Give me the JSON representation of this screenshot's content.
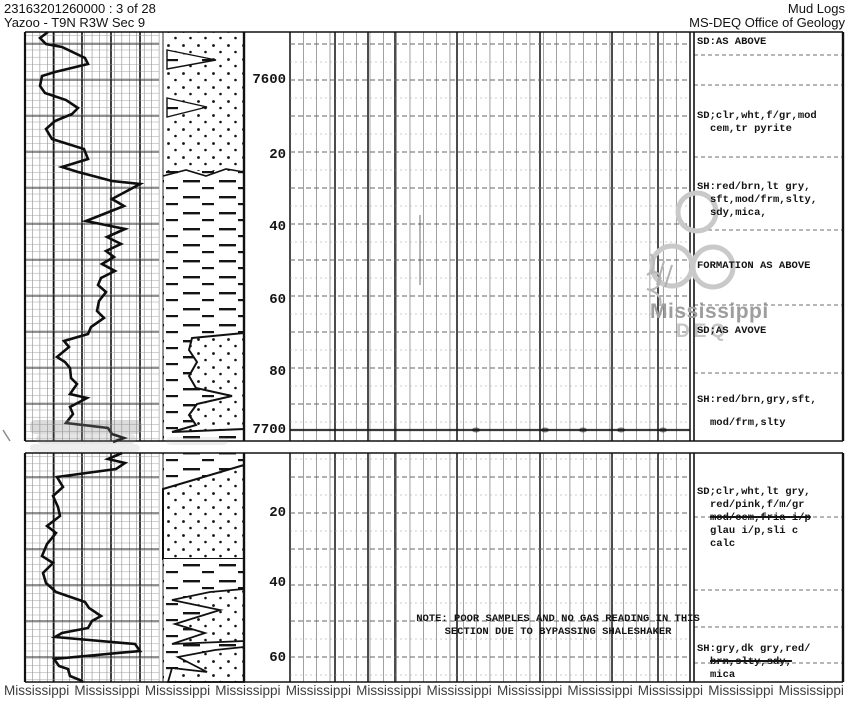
{
  "header": {
    "doc_ref": "23163201260000 : 3 of 28",
    "well_name": "Yazoo - T9N R3W Sec 9",
    "doc_type": "Mud Logs",
    "agency": "MS-DEQ Office of Geology"
  },
  "note": {
    "line1": "NOTE: POOR SAMPLES AND NO GAS READING IN THIS",
    "line2": "SECTION DUE TO BYPASSING SHALESHAKER"
  },
  "watermark": {
    "word": "Mississippi",
    "deq": "DEQ",
    "bottom_repeat": 12
  },
  "colors": {
    "ink": "#141414",
    "grid_light": "#999999",
    "grid_mid": "#555555",
    "grid_heavy": "#111111",
    "watermark_gray": "#c9c9c9",
    "watermark_text": "#9e9e9e",
    "footer_gray": "#3d3d3d"
  },
  "chart_data": {
    "type": "well-log",
    "depth_unit": "ft",
    "legend": {
      "dots": "sandstone",
      "dashes": "shale"
    },
    "panels": [
      {
        "top": 32,
        "bot": 441,
        "anchor": 80
      },
      {
        "top": 453,
        "bot": 682,
        "anchor": 513
      }
    ],
    "left_track": {
      "x0": 25,
      "x1": 159,
      "light_dx": 7.45,
      "heavy_x": [
        25,
        53.5,
        82,
        111,
        140
      ]
    },
    "mid_track": {
      "x0": 290,
      "x1": 690,
      "light_dx": 13.33,
      "heavy_x": [
        290,
        335,
        368,
        395,
        457,
        540,
        612,
        658,
        690
      ]
    },
    "right_track": {
      "x0": 694,
      "x1": 843,
      "sep_y": [
        55,
        85,
        157,
        230,
        305,
        373,
        517,
        590,
        627,
        663
      ]
    },
    "panel_border_y": [
      32,
      441,
      453,
      682
    ],
    "vertical_borders": [
      [
        25,
        2.2
      ],
      [
        163,
        0.9
      ],
      [
        244,
        2.4
      ],
      [
        694,
        1.6
      ],
      [
        843,
        2.4
      ]
    ],
    "depth_labels": [
      {
        "text": "7600",
        "y": 80
      },
      {
        "text": "20",
        "y": 155
      },
      {
        "text": "40",
        "y": 227
      },
      {
        "text": "60",
        "y": 300
      },
      {
        "text": "80",
        "y": 372
      },
      {
        "text": "7700",
        "y": 430
      },
      {
        "text": "20",
        "y": 513
      },
      {
        "text": "40",
        "y": 583
      },
      {
        "text": "60",
        "y": 658
      }
    ],
    "descriptions": [
      {
        "y": 36,
        "lines": [
          {
            "t": "SD:AS ABOVE"
          }
        ]
      },
      {
        "y": 110,
        "lines": [
          {
            "t": "SD;clr,wht,f/gr,mod"
          },
          {
            "t": "cem,tr pyrite",
            "indent": 1
          }
        ]
      },
      {
        "y": 181,
        "lines": [
          {
            "t": "SH:red/brn,lt gry,"
          },
          {
            "t": "sft,mod/frm,slty,",
            "indent": 1
          },
          {
            "t": "sdy,mica,",
            "indent": 1
          }
        ]
      },
      {
        "y": 260,
        "lines": [
          {
            "t": "FORMATION AS ABOVE"
          }
        ]
      },
      {
        "y": 325,
        "lines": [
          {
            "t": "SD;AS AVOVE"
          }
        ]
      },
      {
        "y": 394,
        "lines": [
          {
            "t": "SH:red/brn,gry,sft,"
          },
          {
            "t": "mod/frm,slty",
            "indent": 1,
            "gap": 10
          }
        ]
      },
      {
        "y": 486,
        "lines": [
          {
            "t": "SD;clr,wht,lt gry,"
          },
          {
            "t": "red/pink,f/m/gr",
            "indent": 1
          },
          {
            "t": "mod/cem,fria i/p",
            "indent": 1,
            "struck": true
          },
          {
            "t": "glau i/p,sli c",
            "indent": 1
          },
          {
            "t": "calc",
            "indent": 1
          }
        ]
      },
      {
        "y": 643,
        "lines": [
          {
            "t": "SH:gry,dk gry,red/"
          },
          {
            "t": "brn,slty,sdy,",
            "indent": 1,
            "struck": true
          },
          {
            "t": "mica",
            "indent": 1
          }
        ]
      }
    ],
    "curve": {
      "panel1": [
        [
          48,
          32
        ],
        [
          40,
          38
        ],
        [
          46,
          44
        ],
        [
          62,
          47
        ],
        [
          85,
          58
        ],
        [
          88,
          64
        ],
        [
          55,
          72
        ],
        [
          42,
          76
        ],
        [
          40,
          86
        ],
        [
          45,
          93
        ],
        [
          66,
          100
        ],
        [
          78,
          108
        ],
        [
          72,
          114
        ],
        [
          55,
          121
        ],
        [
          46,
          129
        ],
        [
          52,
          139
        ],
        [
          84,
          149
        ],
        [
          88,
          159
        ],
        [
          62,
          167
        ],
        [
          78,
          172
        ],
        [
          97,
          177
        ],
        [
          112,
          181
        ],
        [
          140,
          184
        ],
        [
          112,
          199
        ],
        [
          124,
          206
        ],
        [
          86,
          221
        ],
        [
          125,
          229
        ],
        [
          107,
          237
        ],
        [
          121,
          244
        ],
        [
          106,
          251
        ],
        [
          114,
          257
        ],
        [
          102,
          264
        ],
        [
          115,
          271
        ],
        [
          101,
          278
        ],
        [
          98,
          285
        ],
        [
          106,
          292
        ],
        [
          99,
          301
        ],
        [
          97,
          311
        ],
        [
          104,
          318
        ],
        [
          91,
          327
        ],
        [
          88,
          334
        ],
        [
          64,
          341
        ],
        [
          69,
          347
        ],
        [
          57,
          357
        ],
        [
          65,
          362
        ],
        [
          70,
          368
        ],
        [
          71,
          378
        ],
        [
          77,
          384
        ],
        [
          70,
          394
        ],
        [
          87,
          398
        ],
        [
          70,
          407
        ],
        [
          73,
          414
        ],
        [
          66,
          423
        ],
        [
          108,
          428
        ],
        [
          112,
          434
        ],
        [
          124,
          438
        ],
        [
          113,
          442
        ]
      ],
      "panel2": [
        [
          122,
          453
        ],
        [
          108,
          459
        ],
        [
          125,
          463
        ],
        [
          116,
          469
        ],
        [
          57,
          477
        ],
        [
          63,
          487
        ],
        [
          53,
          496
        ],
        [
          58,
          507
        ],
        [
          60,
          516
        ],
        [
          47,
          526
        ],
        [
          56,
          533
        ],
        [
          47,
          544
        ],
        [
          42,
          556
        ],
        [
          53,
          563
        ],
        [
          43,
          573
        ],
        [
          46,
          583
        ],
        [
          56,
          592
        ],
        [
          85,
          602
        ],
        [
          89,
          608
        ],
        [
          101,
          616
        ],
        [
          92,
          621
        ],
        [
          88,
          628
        ],
        [
          62,
          633
        ],
        [
          55,
          637
        ],
        [
          135,
          644
        ],
        [
          140,
          651
        ],
        [
          54,
          659
        ],
        [
          59,
          666
        ],
        [
          68,
          669
        ],
        [
          70,
          676
        ],
        [
          80,
          680
        ],
        [
          83,
          682
        ]
      ]
    },
    "lithology": {
      "shapes": [
        {
          "fill": "dots",
          "rect": [
            166,
            32,
            78,
            139
          ]
        },
        {
          "fill": "dashes",
          "points": [
            [
              167,
              50
            ],
            [
              216,
              60
            ],
            [
              167,
              69
            ]
          ],
          "stroke": 1.4
        },
        {
          "fill": "dashes",
          "points": [
            [
              167,
              98
            ],
            [
              207,
              107
            ],
            [
              167,
              117
            ]
          ],
          "stroke": 1.4
        },
        {
          "fill": "dashes",
          "rect": [
            163,
            171,
            81,
            165
          ]
        },
        {
          "line": [
            [
              163,
              176
            ],
            [
              186,
              170
            ],
            [
              206,
              176
            ],
            [
              226,
              169
            ],
            [
              244,
              172
            ]
          ],
          "w": 1.6
        },
        {
          "fill": "dashes",
          "rect": [
            163,
            336,
            81,
            105
          ]
        },
        {
          "fill": "dots",
          "points": [
            [
              192,
              338
            ],
            [
              244,
              333
            ],
            [
              244,
              429
            ],
            [
              172,
              432
            ],
            [
              196,
              425
            ],
            [
              189,
              415
            ],
            [
              197,
              404
            ],
            [
              232,
              396
            ],
            [
              196,
              388
            ],
            [
              189,
              376
            ],
            [
              197,
              362
            ],
            [
              189,
              350
            ]
          ],
          "stroke": 2
        },
        {
          "fill": "dashes",
          "rect": [
            163,
            453,
            81,
            30
          ]
        },
        {
          "fill": "dots",
          "points": [
            [
              163,
              489
            ],
            [
              244,
              465
            ],
            [
              244,
              559
            ],
            [
              163,
              559
            ]
          ],
          "stroke": 2
        },
        {
          "fill": "dashes",
          "rect": [
            163,
            559,
            81,
            123
          ]
        },
        {
          "fill": "dots",
          "points": [
            [
              244,
              589
            ],
            [
              210,
              592
            ],
            [
              172,
              600
            ],
            [
              220,
              610
            ],
            [
              175,
              624
            ],
            [
              205,
              633
            ],
            [
              172,
              644
            ],
            [
              244,
              641
            ]
          ],
          "stroke": 1.8
        },
        {
          "fill": "dots",
          "points": [
            [
              244,
              647
            ],
            [
              215,
              650
            ],
            [
              178,
              657
            ],
            [
              207,
              672
            ],
            [
              172,
              668
            ],
            [
              168,
              682
            ],
            [
              244,
              682
            ]
          ],
          "stroke": 1.8
        }
      ]
    },
    "burn_line": {
      "y": 430,
      "x0": 290,
      "x1": 690,
      "blobs": [
        476,
        545,
        583,
        621,
        663
      ]
    },
    "artifacts": {
      "smudges": [
        [
          30,
          420,
          112,
          14,
          0.32
        ],
        [
          36,
          434,
          100,
          10,
          0.22
        ],
        [
          30,
          444,
          110,
          8,
          0.16
        ],
        [
          166,
          437,
          62,
          8,
          0.15
        ]
      ],
      "tick": [
        3,
        430,
        10,
        441
      ],
      "dark_vline": [
        420,
        215,
        285
      ]
    },
    "logo": {
      "circles": [
        [
          697,
          212,
          19
        ],
        [
          672,
          266,
          20
        ],
        [
          713,
          267,
          20
        ]
      ]
    }
  }
}
